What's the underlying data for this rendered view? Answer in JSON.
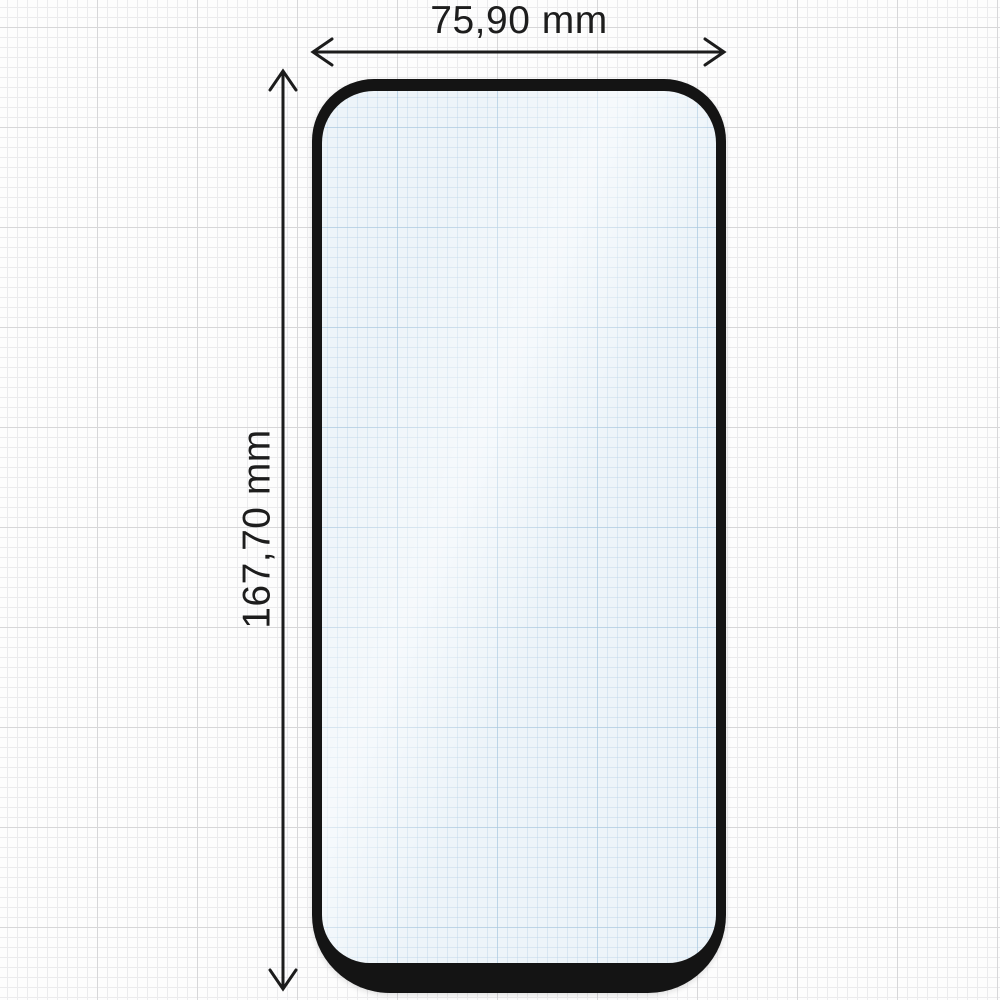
{
  "diagram": {
    "subject": "screen-protector-dimension-drawing",
    "width_label": "75,90 mm",
    "height_label": "167,70 mm"
  },
  "colors": {
    "background": "#fdfdfd",
    "grid_minor": "#ebebed",
    "grid_major": "#d7d7d9",
    "dimension_line": "#1c1c1c",
    "label_text": "#1d1d1d",
    "protector_frame": "#141414",
    "glass_tint": "#edf4f9",
    "glass_grid_minor": "#bed6e8",
    "glass_grid_major": "#a8c6de"
  }
}
